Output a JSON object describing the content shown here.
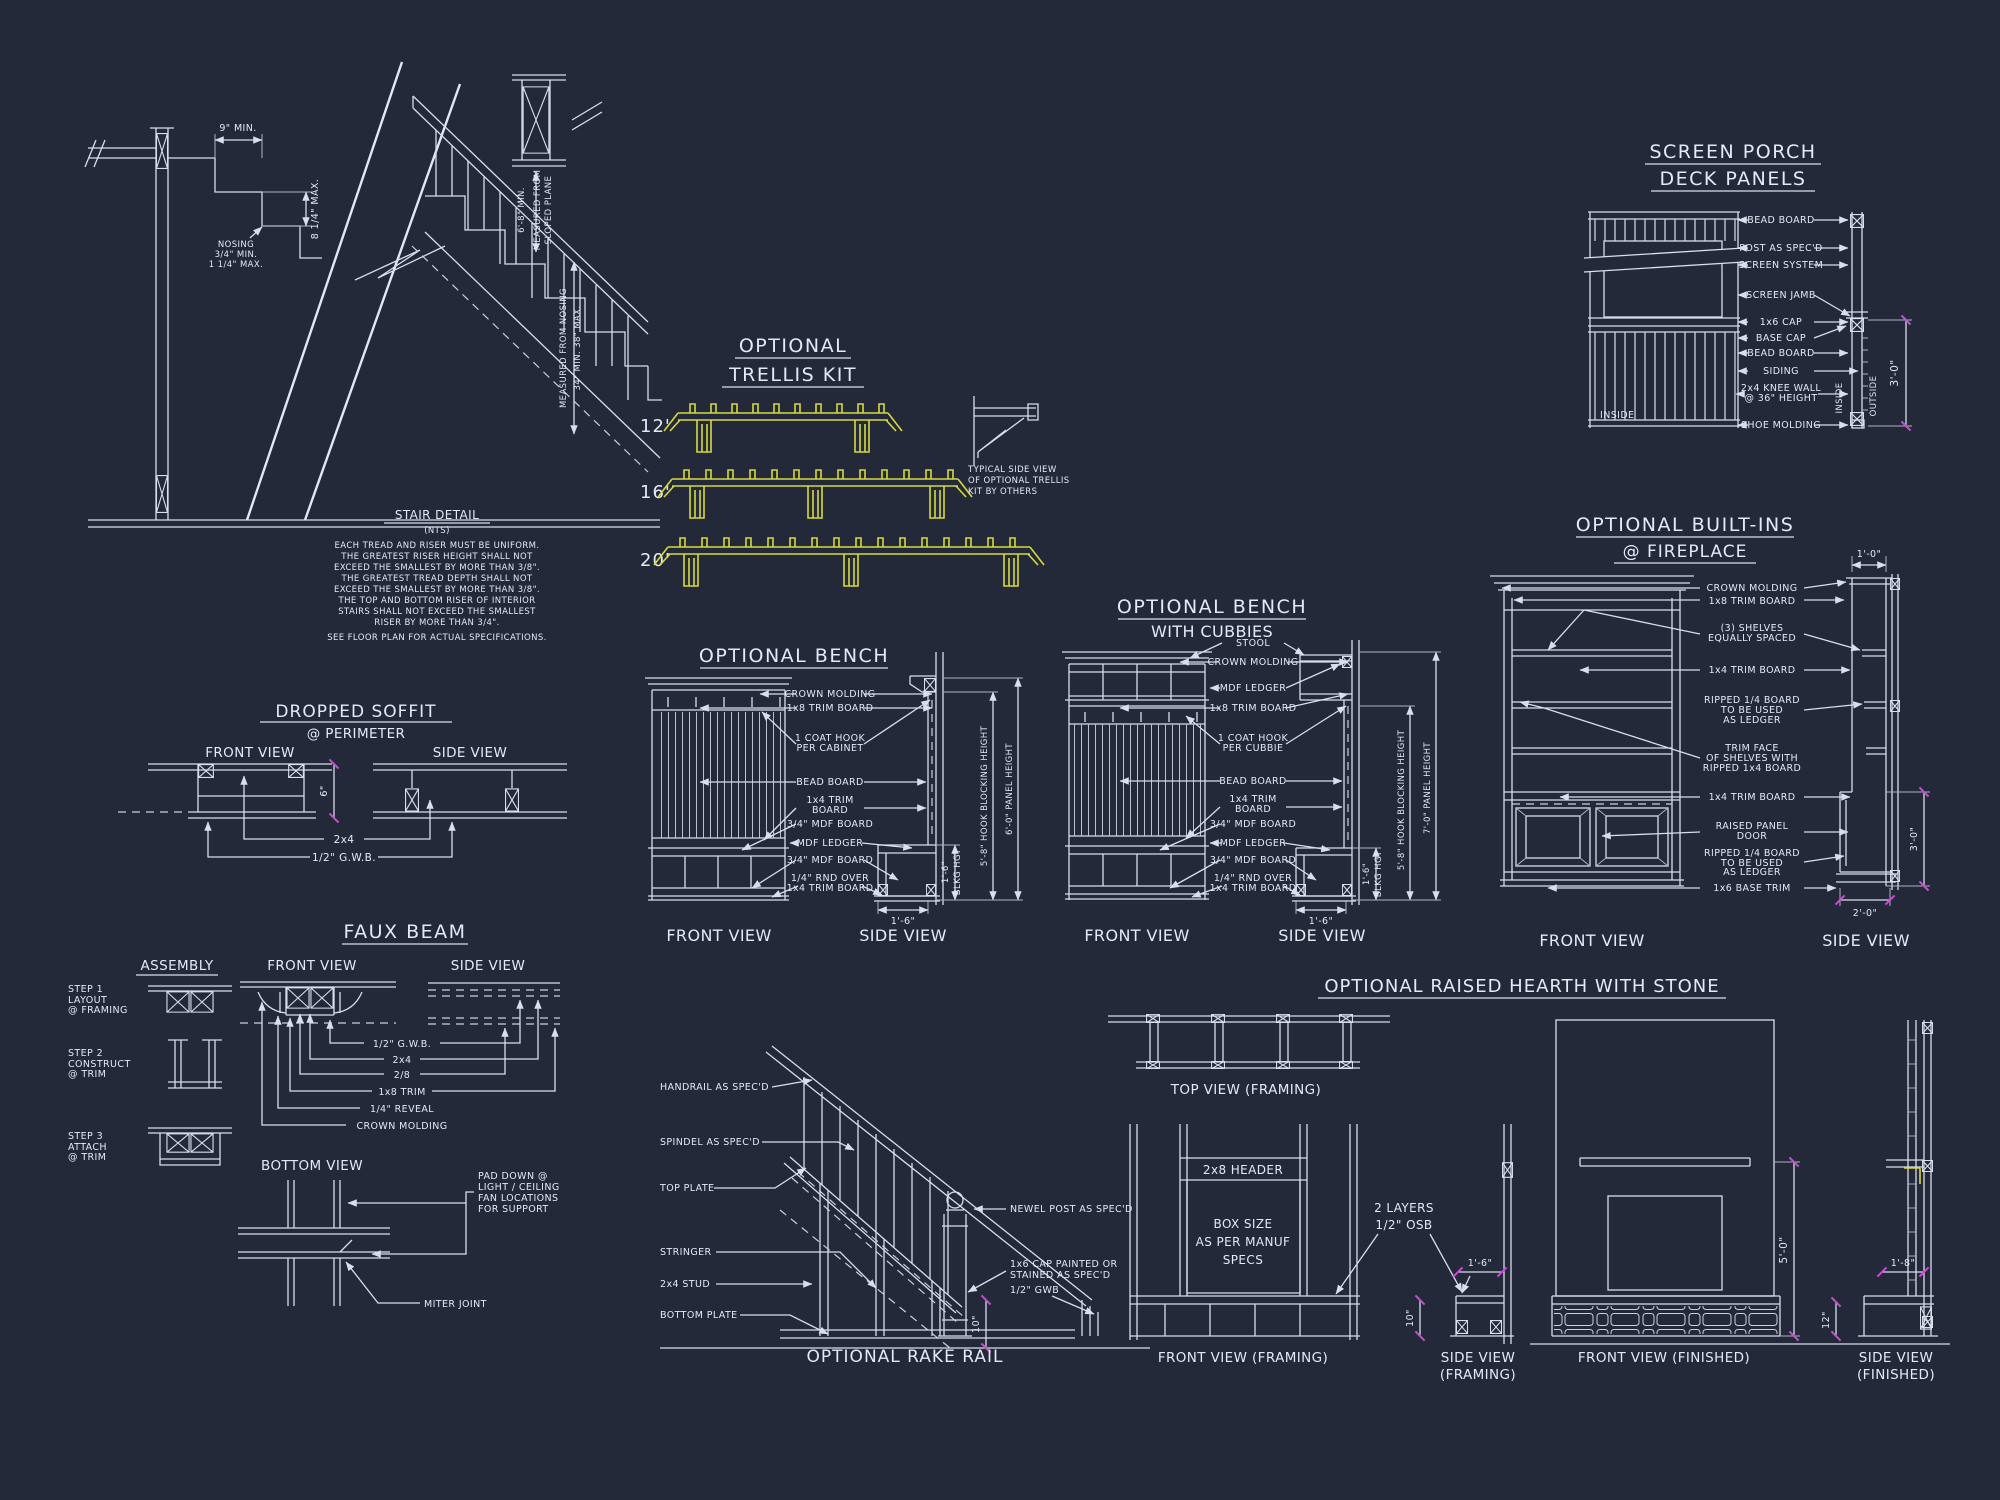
{
  "palette": {
    "background": "#232939",
    "line": "#d8deea",
    "accent_yellow": "#d6d93e",
    "accent_magenta": "#c94bd4"
  },
  "stair": {
    "dim_tread": "9\" MIN.",
    "dim_riser": "8 1/4\" MAX.",
    "nosing": [
      "NOSING",
      "3/4\" MIN.",
      "1 1/4\" MAX."
    ],
    "headroom": [
      "6'-8\" MIN.",
      "MEASURED FROM",
      "SLOPED PLANE"
    ],
    "handrail": [
      "MEASURED FROM NOSING",
      "34\" MIN.  38\" MAX."
    ],
    "note_title": "STAIR DETAIL",
    "note_scale": "(NTS)",
    "notes": [
      "EACH TREAD AND RISER MUST BE UNIFORM.",
      "THE GREATEST RISER HEIGHT SHALL NOT",
      "EXCEED THE SMALLEST BY MORE THAN  3/8\".",
      "THE GREATEST TREAD DEPTH SHALL NOT",
      "EXCEED THE SMALLEST BY MORE THAN  3/8\".",
      "THE TOP AND BOTTOM RISER OF INTERIOR",
      "STAIRS SHALL NOT EXCEED THE SMALLEST",
      "RISER BY MORE THAN 3/4\"."
    ],
    "note_footer": "SEE FLOOR PLAN FOR ACTUAL SPECIFICATIONS."
  },
  "trellis": {
    "title": [
      "OPTIONAL",
      "TRELLIS KIT"
    ],
    "sizes": [
      "12'",
      "16'",
      "20'"
    ],
    "side_note": [
      "TYPICAL SIDE VIEW",
      "OF OPTIONAL TRELLIS",
      "KIT BY OTHERS"
    ]
  },
  "screen_porch": {
    "title": [
      "SCREEN PORCH",
      "DECK PANELS"
    ],
    "labels": [
      "BEAD BOARD",
      "POST AS SPEC'D",
      "SCREEN SYSTEM",
      "SCREEN JAMB",
      "1x6 CAP",
      "BASE CAP",
      "BEAD BOARD",
      "SIDING",
      "2x4 KNEE WALL",
      "@ 36\" HEIGHT",
      "SHOE MOLDING"
    ],
    "inside_left": "INSIDE",
    "inside_right": "INSIDE",
    "outside": "OUTSIDE",
    "dim_height": "3'-0\""
  },
  "bench": {
    "title": "OPTIONAL BENCH",
    "crown": "CROWN MOLDING",
    "trim8": "1x8 TRIM BOARD",
    "hook": [
      "1 COAT HOOK",
      "PER CABINET"
    ],
    "bead": "BEAD BOARD",
    "trim4": [
      "1x4 TRIM",
      "BOARD"
    ],
    "mdf_top": "3/4\" MDF BOARD",
    "ledger": "MDF LEDGER",
    "mdf_bottom": "3/4\" MDF BOARD",
    "rnd": [
      "1/4\" RND OVER",
      "1x4 TRIM BOARD"
    ],
    "dim_depth": "1'-6\"",
    "dim_blkg": [
      "1'-6\"",
      "BLKG HGT"
    ],
    "dim_hook": "5'-8\" HOOK BLOCKING HEIGHT",
    "dim_panel": "6'-0\" PANEL HEIGHT",
    "front_view": "FRONT VIEW",
    "side_view": "SIDE VIEW"
  },
  "bench_cubbies": {
    "title": [
      "OPTIONAL BENCH",
      "WITH CUBBIES"
    ],
    "stool": "STOOL",
    "crown": "CROWN MOLDING",
    "ledger_top": "MDF LEDGER",
    "trim8": "1x8 TRIM BOARD",
    "hook": [
      "1 COAT HOOK",
      "PER CUBBIE"
    ],
    "bead": "BEAD BOARD",
    "trim4": [
      "1x4 TRIM",
      "BOARD"
    ],
    "mdf_top": "3/4\" MDF BOARD",
    "ledger": "MDF LEDGER",
    "mdf_bottom": "3/4\" MDF BOARD",
    "rnd": [
      "1/4\" RND OVER",
      "1x4 TRIM BOARD"
    ],
    "dim_depth": "1'-6\"",
    "dim_blkg": [
      "1'-6\"",
      "BLKG HGT"
    ],
    "dim_hook": "5'-8\" HOOK BLOCKING HEIGHT",
    "dim_panel": "7'-0\" PANEL HEIGHT",
    "front_view": "FRONT VIEW",
    "side_view": "SIDE VIEW"
  },
  "builtins": {
    "title": [
      "OPTIONAL BUILT-INS",
      "@ FIREPLACE"
    ],
    "crown": "CROWN MOLDING",
    "trim8": "1x8 TRIM BOARD",
    "shelves": [
      "(3) SHELVES",
      "EQUALLY SPACED"
    ],
    "trim4_upper": "1x4 TRIM BOARD",
    "ripped_upper": [
      "RIPPED 1/4 BOARD",
      "TO BE USED",
      "AS LEDGER"
    ],
    "trim_face": [
      "TRIM FACE",
      "OF SHELVES WITH",
      "RIPPED 1x4 BOARD"
    ],
    "trim4_lower": "1x4 TRIM BOARD",
    "door": [
      "RAISED PANEL",
      "DOOR"
    ],
    "ripped_lower": [
      "RIPPED 1/4 BOARD",
      "TO BE USED",
      "AS LEDGER"
    ],
    "base_trim": "1x6 BASE TRIM",
    "dim_top": "1'-0\"",
    "dim_side": "3'-0\"",
    "dim_bottom": "2'-0\"",
    "front_view": "FRONT VIEW",
    "side_view": "SIDE VIEW"
  },
  "soffit": {
    "title": [
      "DROPPED SOFFIT",
      "@ PERIMETER"
    ],
    "front_view": "FRONT VIEW",
    "side_view": "SIDE VIEW",
    "framing": "2x4",
    "gwb": "1/2\" G.W.B.",
    "dim_drop": "6\""
  },
  "faux_beam": {
    "title": "FAUX BEAM",
    "assembly": "ASSEMBLY",
    "step1": [
      "STEP 1",
      "LAYOUT",
      "@ FRAMING"
    ],
    "step2": [
      "STEP 2",
      "CONSTRUCT",
      "@ TRIM"
    ],
    "step3": [
      "STEP 3",
      "ATTACH",
      "@ TRIM"
    ],
    "front_view": "FRONT VIEW",
    "side_view": "SIDE VIEW",
    "bottom_view": "BOTTOM VIEW",
    "labels": [
      "1/2\" G.W.B.",
      "2x4",
      "2/8",
      "1x8 TRIM",
      "1/4\" REVEAL",
      "CROWN MOLDING"
    ],
    "pad_note": [
      "PAD DOWN @",
      "LIGHT / CEILING",
      "FAN LOCATIONS",
      "FOR SUPPORT"
    ],
    "miter": "MITER JOINT"
  },
  "rake_rail": {
    "left_labels": [
      "HANDRAIL AS SPEC'D",
      "SPINDEL AS SPEC'D",
      "TOP PLATE",
      "STRINGER",
      "2x4 STUD",
      "BOTTOM PLATE"
    ],
    "newel": "NEWEL POST AS SPEC'D",
    "cap": [
      "1x6 CAP PAINTED OR",
      "STAINED AS SPEC'D"
    ],
    "gwb": "1/2\" GWB",
    "dim_base": "10\"",
    "title": "OPTIONAL RAKE RAIL"
  },
  "hearth": {
    "title": "OPTIONAL RAISED HEARTH WITH STONE",
    "top_view": "TOP VIEW (FRAMING)",
    "header": "2x8 HEADER",
    "box_note": [
      "BOX SIZE",
      "AS PER MANUF",
      "SPECS"
    ],
    "osb_note": [
      "2 LAYERS",
      "1/2\" OSB"
    ],
    "front_framing": "FRONT VIEW (FRAMING)",
    "side_framing": [
      "SIDE VIEW",
      "(FRAMING)"
    ],
    "dim_seat": "1'-6\"",
    "dim_toe": "10\"",
    "front_finished": "FRONT VIEW (FINISHED)",
    "dim_height": "5'-0\"",
    "side_finished": [
      "SIDE VIEW",
      "(FINISHED)"
    ],
    "dim_depth": "1'-8\"",
    "dim_hearth": "12\""
  }
}
